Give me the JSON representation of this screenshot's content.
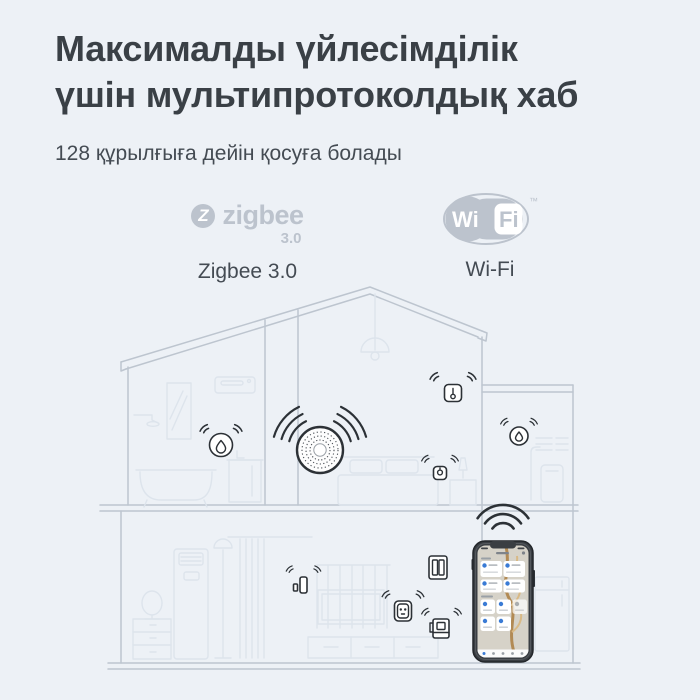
{
  "theme": {
    "bg": "#edf1f6",
    "heading_color": "#3a4046",
    "body_color": "#444b53",
    "logo_grey": "#bcc3cd",
    "wall_line": "#bdc5cf",
    "furniture_line": "#dde4ec",
    "device_dark": "#2c3136",
    "accent_blue": "#3a7bd5",
    "branch_brown": "#b28a54",
    "phone_screen_bg": "#d6d2c8"
  },
  "header": {
    "title": "Максималды үйлесімділік\nүшін мультипротоколдық хаб",
    "subtitle": "128 құрылғыға дейін қосуға болады"
  },
  "protocols": {
    "zigbee": {
      "logo_symbol": "Z",
      "logo_text": "zigbee",
      "logo_version": "3.0",
      "label": "Zigbee 3.0"
    },
    "wifi": {
      "logo_left": "Wi",
      "logo_right": "Fi",
      "trademark": "™",
      "label": "Wi-Fi"
    }
  },
  "illustration": {
    "subject": "two-storey house cross-section with smart home devices",
    "hub": "multi-protocol-hub-with-radio-waves",
    "devices": [
      "water-leak-sensor-bathroom",
      "temperature-sensor-bedroom",
      "motion-sensor-bedroom",
      "water-leak-sensor-annex",
      "door-window-sensor",
      "smart-plug",
      "smart-kettle",
      "wall-switch",
      "smartphone-with-smart-home-app"
    ]
  }
}
